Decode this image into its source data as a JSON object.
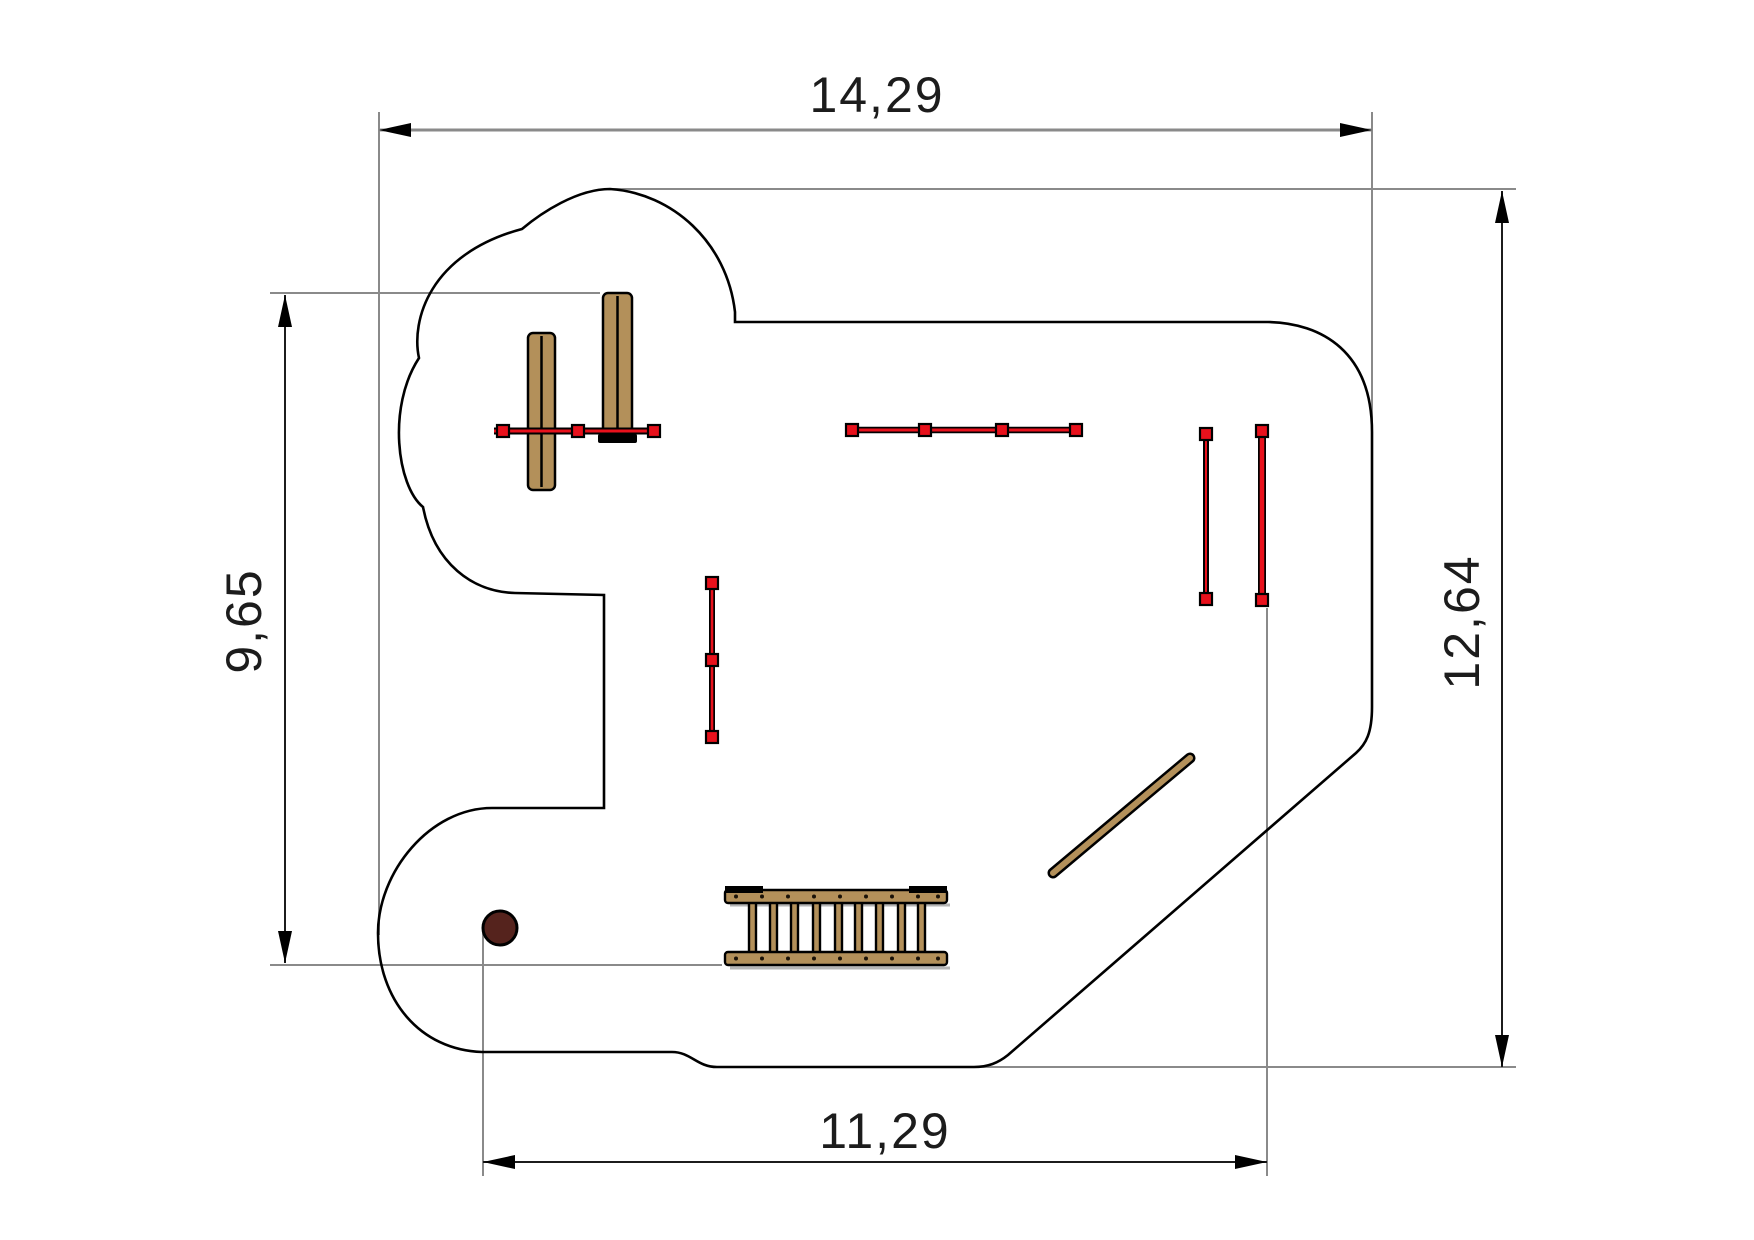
{
  "figure": {
    "dimensions": {
      "width_top": "14,29",
      "height_right": "12,64",
      "height_left": "9,65",
      "width_bottom": "11,29"
    },
    "colors": {
      "wood": "#b3905a",
      "red": "#e8111c",
      "circle": "#55231d",
      "outline": "#000000",
      "extension_line": "#8a8a8a"
    },
    "equipment": [
      {
        "name": "swing-frame"
      },
      {
        "name": "overhead-beam"
      },
      {
        "name": "short-balance-beam"
      },
      {
        "name": "parallel-posts"
      },
      {
        "name": "horizontal-ladder"
      },
      {
        "name": "inclined-beam"
      },
      {
        "name": "round-post"
      }
    ]
  }
}
